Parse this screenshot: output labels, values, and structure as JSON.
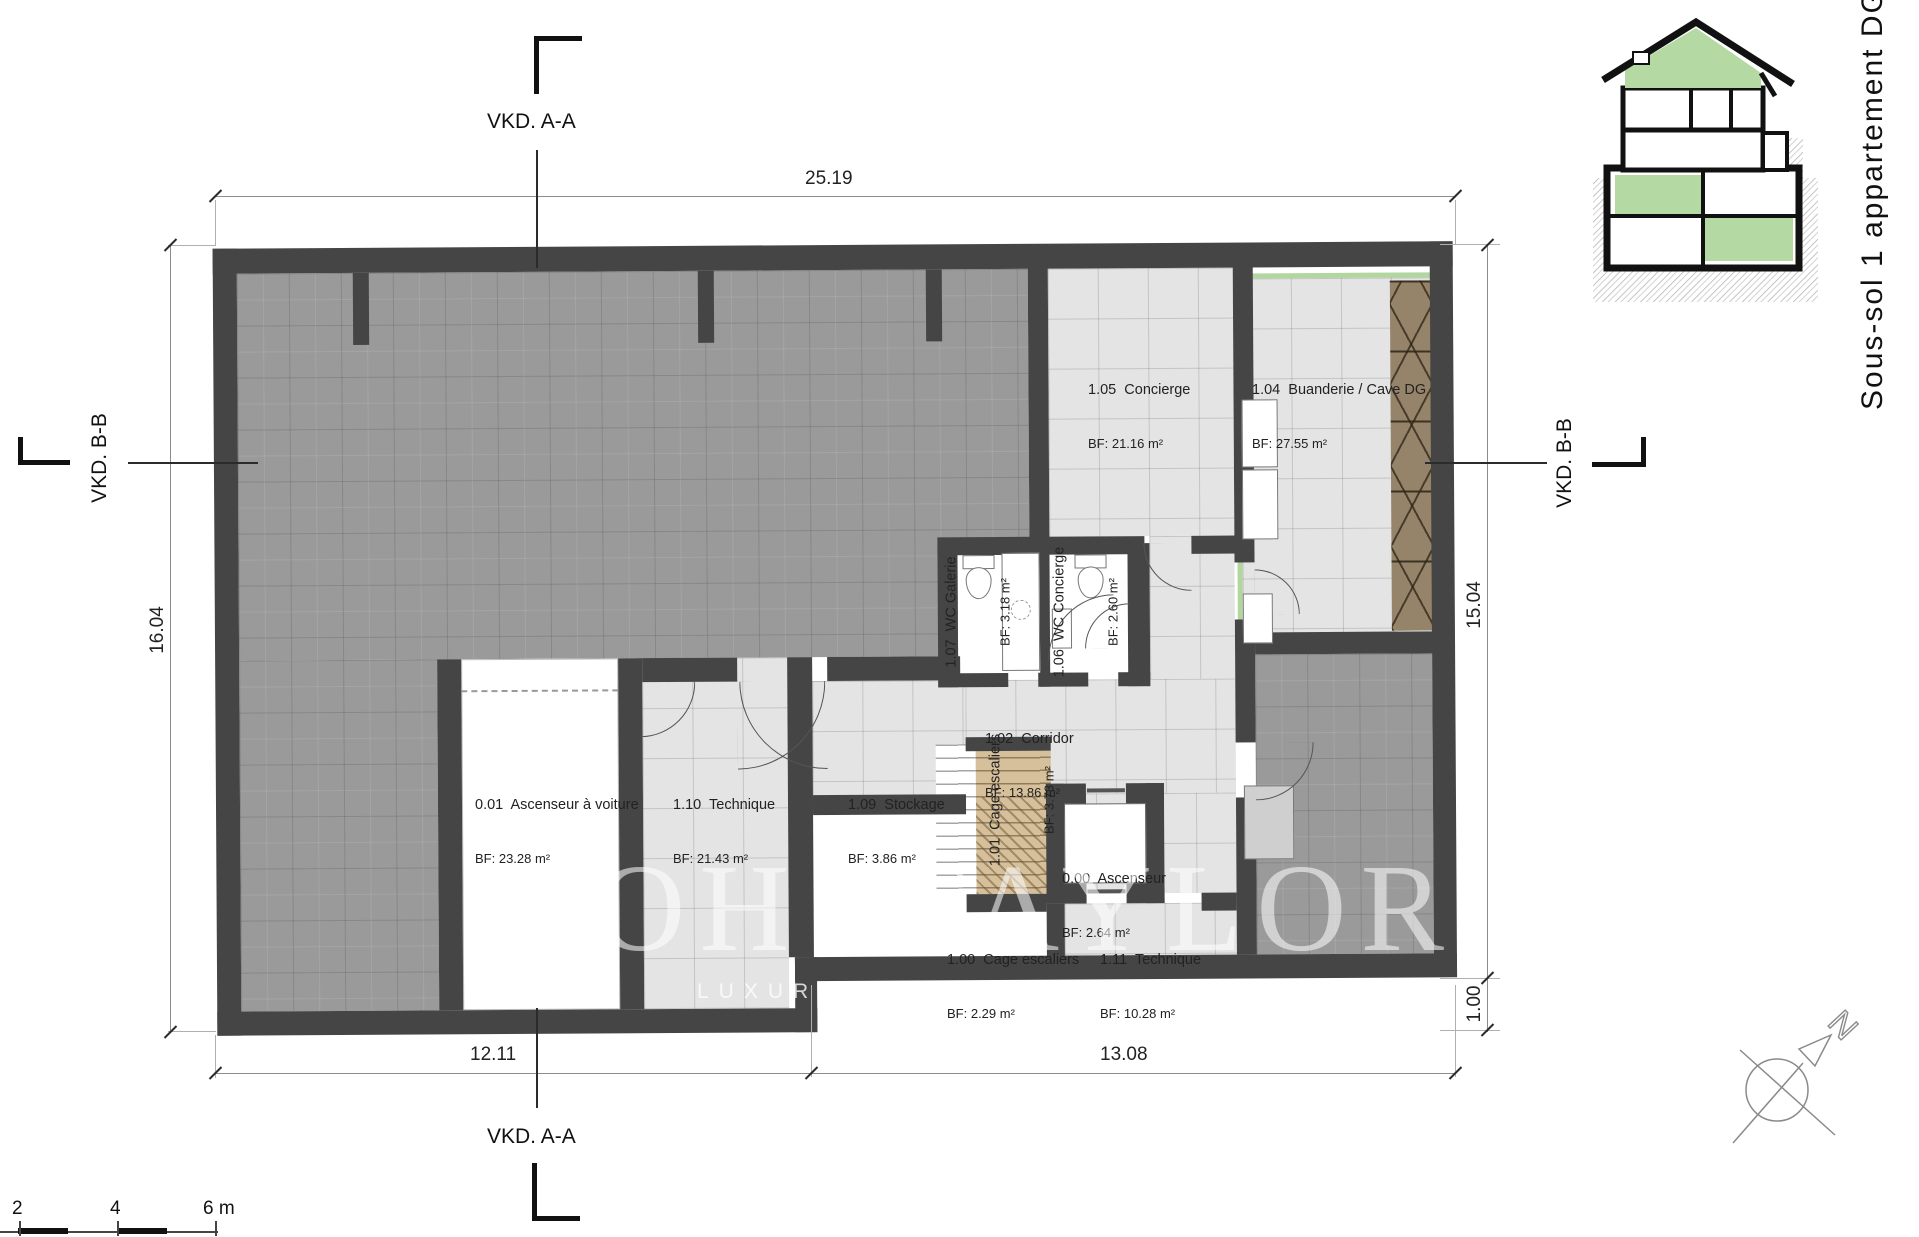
{
  "title": "Sous-sol 1 appartement DG",
  "watermark": {
    "brand": "OH TAYLOR",
    "tagline": "LUXURY"
  },
  "sections": {
    "top": "VKD. A-A",
    "bottom": "VKD. A-A",
    "left": "VKD. B-B",
    "right": "VKD. B-B"
  },
  "dimensions": {
    "top": "25.19",
    "left": "16.04",
    "right_main": "15.04",
    "right_small": "1.00",
    "bottom_left": "12.11",
    "bottom_right": "13.08"
  },
  "scale_bar": {
    "t2": "2",
    "t4": "4",
    "t6": "6 m"
  },
  "north_label": "N",
  "rooms": [
    {
      "label": "0.01  Ascenseur à voiture",
      "area": "BF: 23.28 m²"
    },
    {
      "label": "1.10  Technique",
      "area": "BF: 21.43 m²"
    },
    {
      "label": "1.09  Stockage",
      "area": "BF: 3.86 m²"
    },
    {
      "label": "1.01  Cage escaliers",
      "area": "BF: 3.73 m²"
    },
    {
      "label": "0.00  Ascenseur",
      "area": "BF: 2.64 m²"
    },
    {
      "label": "1.00  Cage escaliers",
      "area": "BF: 2.29 m²"
    },
    {
      "label": "1.11  Technique",
      "area": "BF: 10.28 m²"
    },
    {
      "label": "1.07  WC Galerie",
      "area": "BF: 3.18 m²"
    },
    {
      "label": "1.06  WC Concierge",
      "area": "BF: 2.60 m²"
    },
    {
      "label": "1.02  Corridor",
      "area": "BF: 13.86 m²"
    },
    {
      "label": "1.05  Concierge",
      "area": "BF: 21.16 m²"
    },
    {
      "label": "1.04  Buanderie / Cave DG",
      "area": "BF: 27.55 m²"
    }
  ],
  "colors": {
    "wall": "#454545",
    "garage_floor": "#9a9a9a",
    "room_floor": "#e4e4e4",
    "stairs": "#d6bf9b",
    "highlight_green": "#b2d79e"
  }
}
